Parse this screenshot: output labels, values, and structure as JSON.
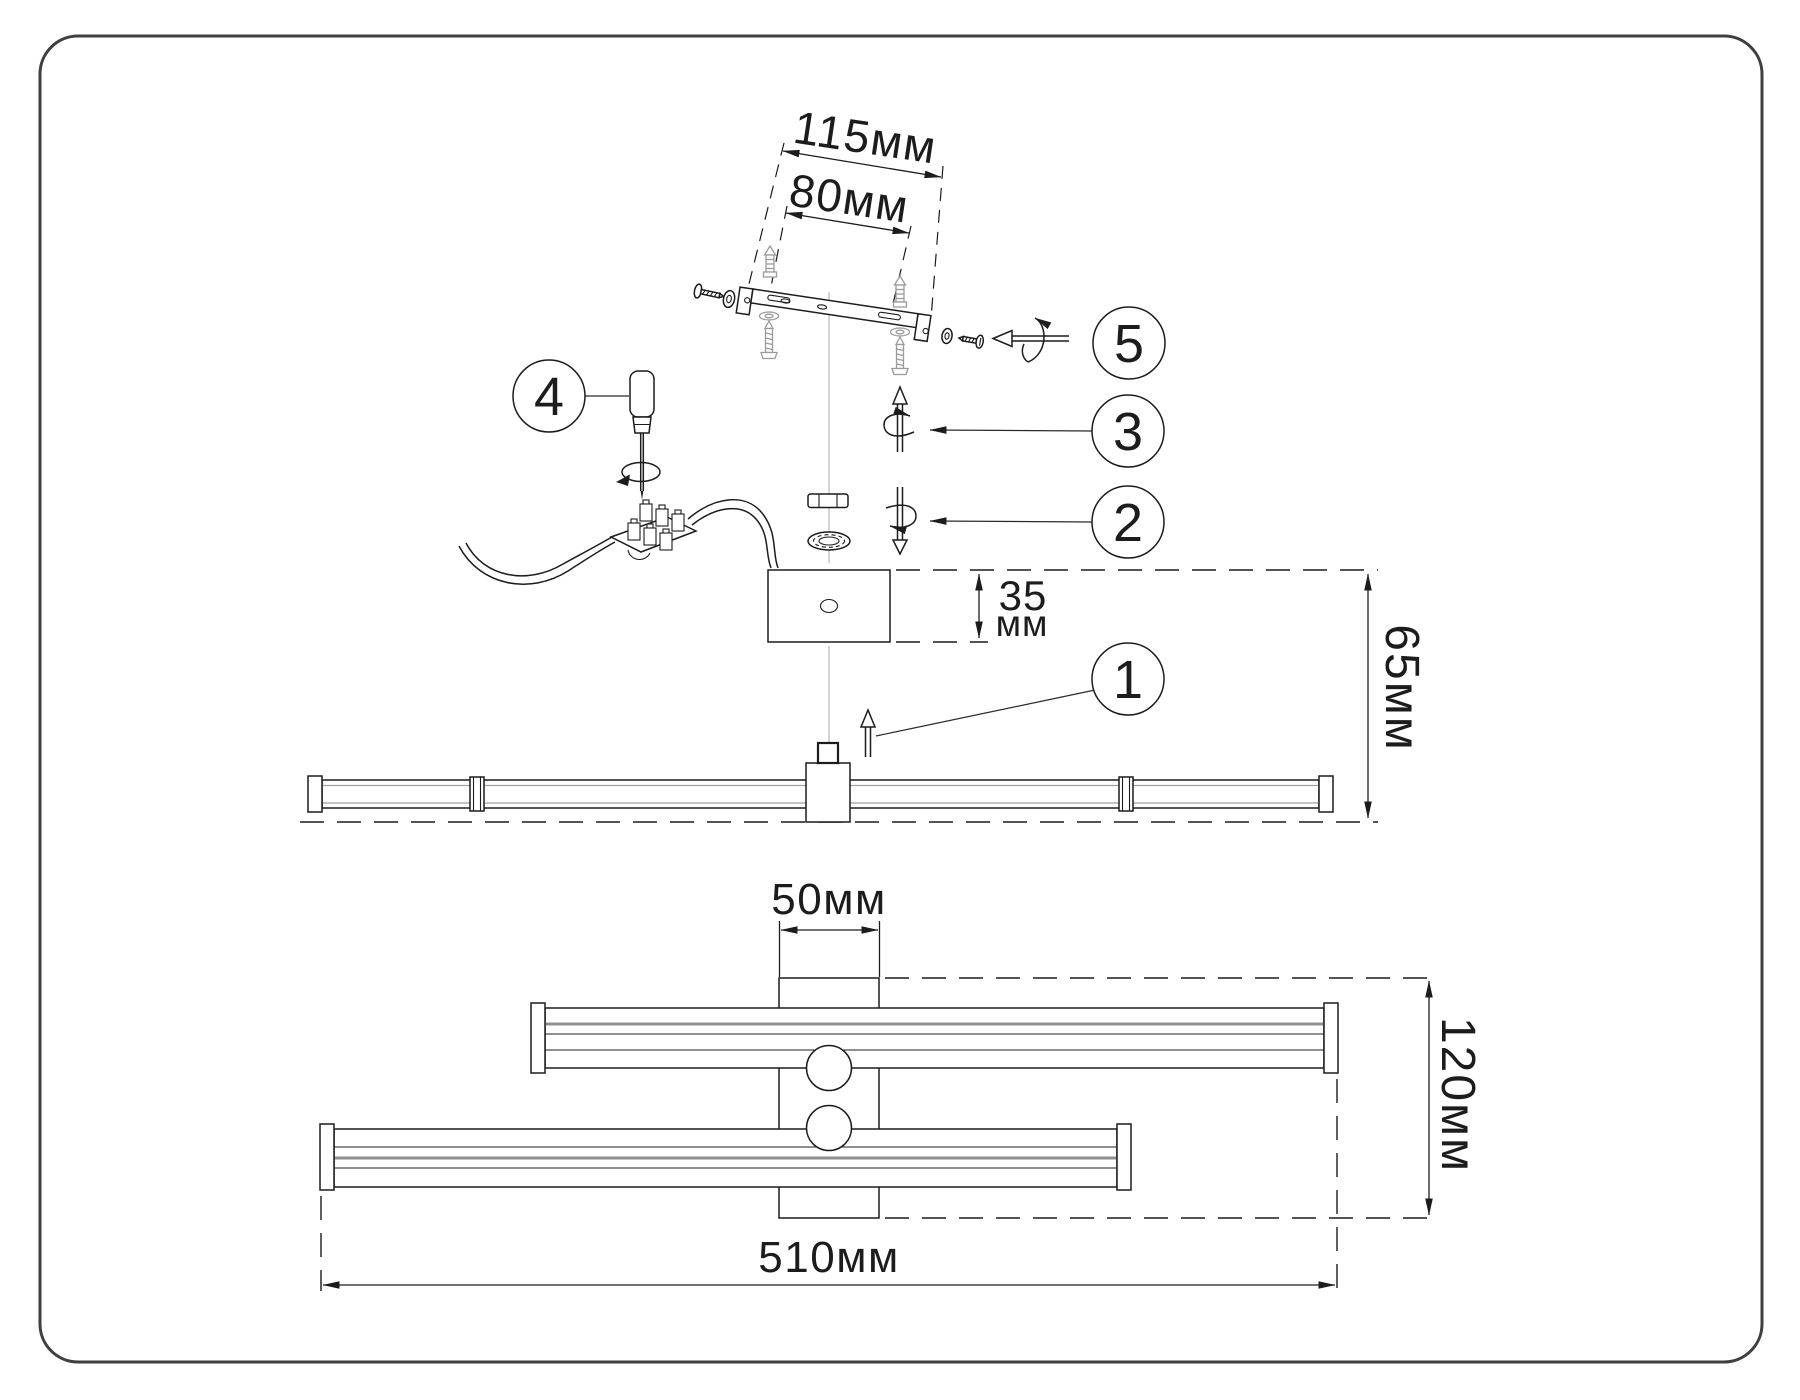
{
  "diagram": {
    "type": "assembly-instruction-diagram",
    "subject": "wall-lamp-mounting",
    "dimensions": {
      "bracket_screw_span": "115мм",
      "bracket_slot_span": "80мм",
      "canopy_height_value": "35",
      "canopy_height_unit": "мм",
      "mount_depth": "65мм",
      "bracket_column_width": "50мм",
      "body_depth": "120мм",
      "total_width": "510мм"
    },
    "steps": {
      "step1": "1",
      "step2": "2",
      "step3": "3",
      "step4": "4",
      "step5": "5"
    },
    "icons": {
      "step1": "lift-up-arrow-icon",
      "step2": "rotate-down-arrow-icon",
      "step3": "rotate-up-arrow-icon",
      "step4": "screwdriver-icon",
      "step5": "rotate-pull-out-arrow-icon",
      "hardware": [
        "wall-bracket-icon",
        "wall-anchor-icon",
        "mounting-screw-icon",
        "washer-icon",
        "hex-nut-icon",
        "lock-washer-icon",
        "terminal-block-icon",
        "wire-icon",
        "canopy-box-icon",
        "lamp-bar-icon"
      ]
    },
    "colors": {
      "line": "#1c1c1c",
      "muted_gray": "#9b9b9b",
      "centerline_gray": "#b8b8b8",
      "highlight_gray": "#8f8f8f",
      "frame": "#3f3f3f",
      "background": "#ffffff"
    }
  }
}
